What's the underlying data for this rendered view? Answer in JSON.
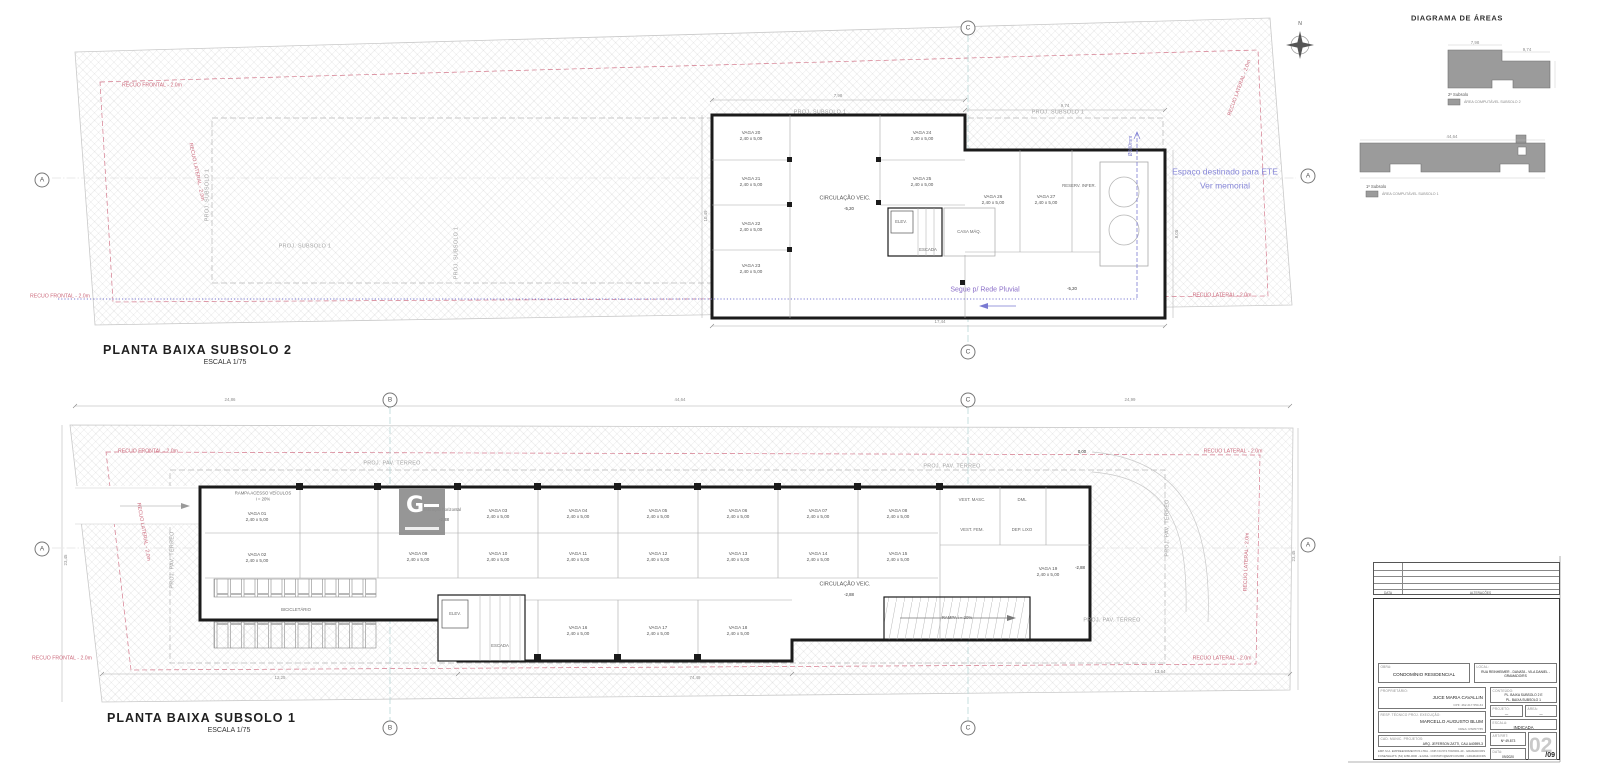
{
  "sheet": {
    "north_letter": "N"
  },
  "plan2": {
    "title": "PLANTA BAIXA SUBSOLO 2",
    "scale": "ESCALA 1/75",
    "labels": [
      {
        "t": "PROJ. SUBSOLO 1",
        "x": 820,
        "y": 113,
        "c": "proj"
      },
      {
        "t": "PROJ. SUBSOLO 1",
        "x": 1058,
        "y": 113,
        "c": "proj"
      },
      {
        "t": "PROJ. SUBSOLO 1",
        "x": 208,
        "y": 195,
        "c": "proj",
        "r": -90
      },
      {
        "t": "PROJ. SUBSOLO 1",
        "x": 305,
        "y": 247,
        "c": "proj"
      },
      {
        "t": "PROJ. SUBSOLO 1",
        "x": 457,
        "y": 253,
        "c": "proj",
        "r": -90
      },
      {
        "t": "RECUO FRONTAL - 2.0m",
        "x": 152,
        "y": 86,
        "c": "red"
      },
      {
        "t": "RECUO LATERAL - 2.0m",
        "x": 1240,
        "y": 88,
        "c": "red",
        "r": -70
      },
      {
        "t": "RECUO LATERAL - 2.0m",
        "x": 196,
        "y": 172,
        "c": "red",
        "r": 78
      },
      {
        "t": "RECUO FRONTAL - 2.0m",
        "x": 60,
        "y": 297,
        "c": "red"
      },
      {
        "t": "RECUO LATERAL - 2.0m",
        "x": 1222,
        "y": 296,
        "c": "red"
      },
      {
        "t": "Espaço destinado para ETE",
        "x": 1225,
        "y": 172,
        "c": "purple"
      },
      {
        "t": "Ver memorial",
        "x": 1225,
        "y": 186,
        "c": "purple"
      },
      {
        "t": "Segue p/ Rede Pluvial",
        "x": 985,
        "y": 290,
        "c": "purple2"
      },
      {
        "t": "Ø100mm",
        "x": 1131,
        "y": 146,
        "c": "purpleSm",
        "r": -90
      },
      {
        "t": "VAGA 20\n2,40 x 5,00",
        "x": 751,
        "y": 136,
        "c": "vaga"
      },
      {
        "t": "VAGA 21\n2,40 x 5,00",
        "x": 751,
        "y": 182,
        "c": "vaga"
      },
      {
        "t": "VAGA 22\n2,40 x 5,00",
        "x": 751,
        "y": 227,
        "c": "vaga"
      },
      {
        "t": "VAGA 23\n2,40 x 5,00",
        "x": 751,
        "y": 269,
        "c": "vaga"
      },
      {
        "t": "VAGA 24\n2,40 x 5,00",
        "x": 922,
        "y": 136,
        "c": "vaga"
      },
      {
        "t": "VAGA 25\n2,40 x 5,00",
        "x": 922,
        "y": 182,
        "c": "vaga"
      },
      {
        "t": "VAGA 26\n2,40 x 5,00",
        "x": 993,
        "y": 200,
        "c": "vaga"
      },
      {
        "t": "VAGA 27\n2,40 x 5,00",
        "x": 1046,
        "y": 200,
        "c": "vaga"
      },
      {
        "t": "CIRCULAÇÃO VEIC.",
        "x": 845,
        "y": 199,
        "c": "room"
      },
      {
        "t": "-5,20",
        "x": 849,
        "y": 209,
        "c": "level"
      },
      {
        "t": "ELEV.",
        "x": 901,
        "y": 222,
        "c": "roomSm"
      },
      {
        "t": "ESCADA",
        "x": 928,
        "y": 250,
        "c": "roomSm"
      },
      {
        "t": "CASA MÁQ.",
        "x": 969,
        "y": 232,
        "c": "roomSm"
      },
      {
        "t": "RESERV. INFER.",
        "x": 1079,
        "y": 186,
        "c": "roomSm"
      },
      {
        "t": "-5,20",
        "x": 1072,
        "y": 289,
        "c": "level"
      },
      {
        "t": "7,98",
        "x": 838,
        "y": 96,
        "c": "dim"
      },
      {
        "t": "9,74",
        "x": 1065,
        "y": 106,
        "c": "dim"
      },
      {
        "t": "17,44",
        "x": 940,
        "y": 322,
        "c": "dim"
      },
      {
        "t": "8,05",
        "x": 1177,
        "y": 234,
        "c": "dim",
        "r": -90
      },
      {
        "t": "10,49",
        "x": 706,
        "y": 216,
        "c": "dim",
        "r": -90
      }
    ]
  },
  "plan1": {
    "title": "PLANTA BAIXA SUBSOLO 1",
    "scale": "ESCALA 1/75",
    "labels": [
      {
        "t": "PROJ. PAV. TÉRREO",
        "x": 392,
        "y": 464,
        "c": "proj"
      },
      {
        "t": "PROJ. PAV. TÉRREO",
        "x": 952,
        "y": 467,
        "c": "proj"
      },
      {
        "t": "PROJ. PAV. TÉRREO",
        "x": 173,
        "y": 560,
        "c": "proj",
        "r": -90
      },
      {
        "t": "PROJ. PAV. TÉRREO",
        "x": 1168,
        "y": 528,
        "c": "proj",
        "r": -90
      },
      {
        "t": "PROJ. PAV. TÉRREO",
        "x": 1112,
        "y": 621,
        "c": "proj"
      },
      {
        "t": "RECUO FRONTAL - 2.0m",
        "x": 148,
        "y": 452,
        "c": "red"
      },
      {
        "t": "RECUO LATERAL - 2.0m",
        "x": 1233,
        "y": 452,
        "c": "red"
      },
      {
        "t": "RECUO LATERAL - 2.0m",
        "x": 143,
        "y": 532,
        "c": "red",
        "r": 80
      },
      {
        "t": "RECUO LATERAL - 2.0m",
        "x": 1247,
        "y": 562,
        "c": "red",
        "r": -88
      },
      {
        "t": "RECUO FRONTAL - 2.0m",
        "x": 62,
        "y": 659,
        "c": "red"
      },
      {
        "t": "RECUO LATERAL - 2.0m",
        "x": 1222,
        "y": 659,
        "c": "red"
      },
      {
        "t": "RAMPA ACESSO VEÍCULOS\ni = 20%",
        "x": 263,
        "y": 496,
        "c": "roomSm"
      },
      {
        "t": "VAGA 01\n2,40 x 5,00",
        "x": 257,
        "y": 517,
        "c": "vaga"
      },
      {
        "t": "VAGA 02\n2,40 x 5,00",
        "x": 257,
        "y": 558,
        "c": "vaga"
      },
      {
        "t": "VAGA 03\n2,40 x 5,00",
        "x": 498,
        "y": 514,
        "c": "vaga"
      },
      {
        "t": "VAGA 04\n2,40 x 5,00",
        "x": 578,
        "y": 514,
        "c": "vaga"
      },
      {
        "t": "VAGA 05\n2,40 x 5,00",
        "x": 658,
        "y": 514,
        "c": "vaga"
      },
      {
        "t": "VAGA 06\n2,40 x 5,00",
        "x": 738,
        "y": 514,
        "c": "vaga"
      },
      {
        "t": "VAGA 07\n2,40 x 5,00",
        "x": 818,
        "y": 514,
        "c": "vaga"
      },
      {
        "t": "VAGA 08\n2,40 x 5,00",
        "x": 898,
        "y": 514,
        "c": "vaga"
      },
      {
        "t": "VAGA 09\n2,40 x 5,00",
        "x": 418,
        "y": 557,
        "c": "vaga"
      },
      {
        "t": "VAGA 10\n2,40 x 5,00",
        "x": 498,
        "y": 557,
        "c": "vaga"
      },
      {
        "t": "VAGA 11\n2,40 x 5,00",
        "x": 578,
        "y": 557,
        "c": "vaga"
      },
      {
        "t": "VAGA 12\n2,40 x 5,00",
        "x": 658,
        "y": 557,
        "c": "vaga"
      },
      {
        "t": "VAGA 13\n2,40 x 5,00",
        "x": 738,
        "y": 557,
        "c": "vaga"
      },
      {
        "t": "VAGA 14\n2,40 x 5,00",
        "x": 818,
        "y": 557,
        "c": "vaga"
      },
      {
        "t": "VAGA 15\n2,40 x 5,00",
        "x": 898,
        "y": 557,
        "c": "vaga"
      },
      {
        "t": "VAGA 16\n2,40 x 5,00",
        "x": 578,
        "y": 631,
        "c": "vaga"
      },
      {
        "t": "VAGA 17\n2,40 x 5,00",
        "x": 658,
        "y": 631,
        "c": "vaga"
      },
      {
        "t": "VAGA 18\n2,40 x 5,00",
        "x": 738,
        "y": 631,
        "c": "vaga"
      },
      {
        "t": "VAGA 19\n2,40 x 5,00",
        "x": 1048,
        "y": 572,
        "c": "vaga"
      },
      {
        "t": "Sinalização horizontal",
        "x": 440,
        "y": 510,
        "c": "roomSm"
      },
      {
        "t": "-2,88",
        "x": 444,
        "y": 520,
        "c": "level"
      },
      {
        "t": "CIRCULAÇÃO VEIC.",
        "x": 845,
        "y": 585,
        "c": "room"
      },
      {
        "t": "-2,88",
        "x": 849,
        "y": 595,
        "c": "level"
      },
      {
        "t": "VEST. MASC.",
        "x": 972,
        "y": 500,
        "c": "roomSm"
      },
      {
        "t": "VEST. FEM.",
        "x": 972,
        "y": 530,
        "c": "roomSm"
      },
      {
        "t": "DML",
        "x": 1022,
        "y": 500,
        "c": "roomSm"
      },
      {
        "t": "DEP. LIXO",
        "x": 1022,
        "y": 530,
        "c": "roomSm"
      },
      {
        "t": "BICICLETÁRIO",
        "x": 296,
        "y": 610,
        "c": "roomSm"
      },
      {
        "t": "ELEV.",
        "x": 455,
        "y": 614,
        "c": "roomSm"
      },
      {
        "t": "ESCADA",
        "x": 500,
        "y": 646,
        "c": "roomSm"
      },
      {
        "t": "RAMPA i = 20%",
        "x": 957,
        "y": 618,
        "c": "roomSm"
      },
      {
        "t": "0,00",
        "x": 1082,
        "y": 452,
        "c": "level"
      },
      {
        "t": "-2,88",
        "x": 1080,
        "y": 568,
        "c": "level"
      },
      {
        "t": "24,86",
        "x": 230,
        "y": 400,
        "c": "dim"
      },
      {
        "t": "44,64",
        "x": 680,
        "y": 400,
        "c": "dim"
      },
      {
        "t": "24,99",
        "x": 1130,
        "y": 400,
        "c": "dim"
      },
      {
        "t": "12,25",
        "x": 280,
        "y": 678,
        "c": "dim"
      },
      {
        "t": "74,49",
        "x": 695,
        "y": 678,
        "c": "dim"
      },
      {
        "t": "13,64",
        "x": 1160,
        "y": 672,
        "c": "dim"
      },
      {
        "t": "23,45",
        "x": 66,
        "y": 560,
        "c": "dim",
        "r": -90
      },
      {
        "t": "23,45",
        "x": 1294,
        "y": 556,
        "c": "dim",
        "r": -90
      }
    ]
  },
  "diagram": {
    "title": "DIAGRAMA DE ÁREAS",
    "legend1_title": "2º Subsolo",
    "legend1_item": "ÁREA COMPUTÁVEL SUBSOLO 2",
    "legend2_title": "1º Subsolo",
    "legend2_item": "ÁREA COMPUTÁVEL SUBSOLO 1",
    "labels": [
      {
        "t": "7,98",
        "x": 1475,
        "y": 43,
        "c": "dim"
      },
      {
        "t": "9,74",
        "x": 1527,
        "y": 50,
        "c": "dim"
      },
      {
        "t": "44,64",
        "x": 1452,
        "y": 137,
        "c": "dim"
      }
    ]
  },
  "markers": [
    {
      "t": "A",
      "x": 42,
      "y": 180
    },
    {
      "t": "A",
      "x": 1308,
      "y": 176
    },
    {
      "t": "C",
      "x": 968,
      "y": 28
    },
    {
      "t": "C",
      "x": 968,
      "y": 352
    },
    {
      "t": "B",
      "x": 390,
      "y": 400
    },
    {
      "t": "C",
      "x": 968,
      "y": 400
    },
    {
      "t": "A",
      "x": 42,
      "y": 549
    },
    {
      "t": "A",
      "x": 1308,
      "y": 545
    },
    {
      "t": "B",
      "x": 390,
      "y": 728
    },
    {
      "t": "C",
      "x": 968,
      "y": 728
    }
  ],
  "logo": {
    "letter": "G"
  },
  "titleblock": {
    "rev_data": "DATA",
    "rev_alt": "ALTERAÇÕES",
    "obra_label": "OBRA:",
    "obra": "CONDOMÍNIO RESIDENCIAL",
    "local_label": "LOCAL:",
    "local": "RUA REINHEIMER - DANATA - VILA DANIEL - GRAMADO/RS",
    "prop_label": "PROPRIETÁRIO:",
    "prop": "JUCE MARIA CAVALLIN",
    "prop_doc": "CPF: 462.217.550-34",
    "resp_label": "RESP. TÉCNICO PROJ. EXECUÇÃO:",
    "resp": "MARCELLO AUGUSTO BLUM",
    "resp_doc": "CREA: RS057735",
    "cad_label": "CAD. MUNIC. PROJETOS:",
    "cad": "ARQ. JEFERSON ZATTI, CAU A40599-3",
    "fine1": "EMP. M.A. EMPREENDIMENTOS LTDA - CNPJ 04.574.700/0001-40 - GRAMADO/RS",
    "fine2": "FONE/WHATS: (54) 3286-0000 - E-MAIL: CONTATO@EMP.COM.BR - GRAMADO/RS",
    "cont_label": "CONTEÚDO:",
    "cont1": "PL. BAIXA SUBSOLO 2 E",
    "cont2": "PL. BAIXA SUBSOLO 1",
    "proj_label": "PROJETO:",
    "proj_val": "—",
    "area_label": "ÁREA:",
    "area_val": "—",
    "escala_label": "ESCALA:",
    "escala_val": "INDICADA",
    "art_label": "ART/RRT:",
    "art_val": "Nº 49.873",
    "data_label": "DATA:",
    "data_val": "09/2020",
    "sheet_num": "02",
    "sheet_total": "/09"
  }
}
